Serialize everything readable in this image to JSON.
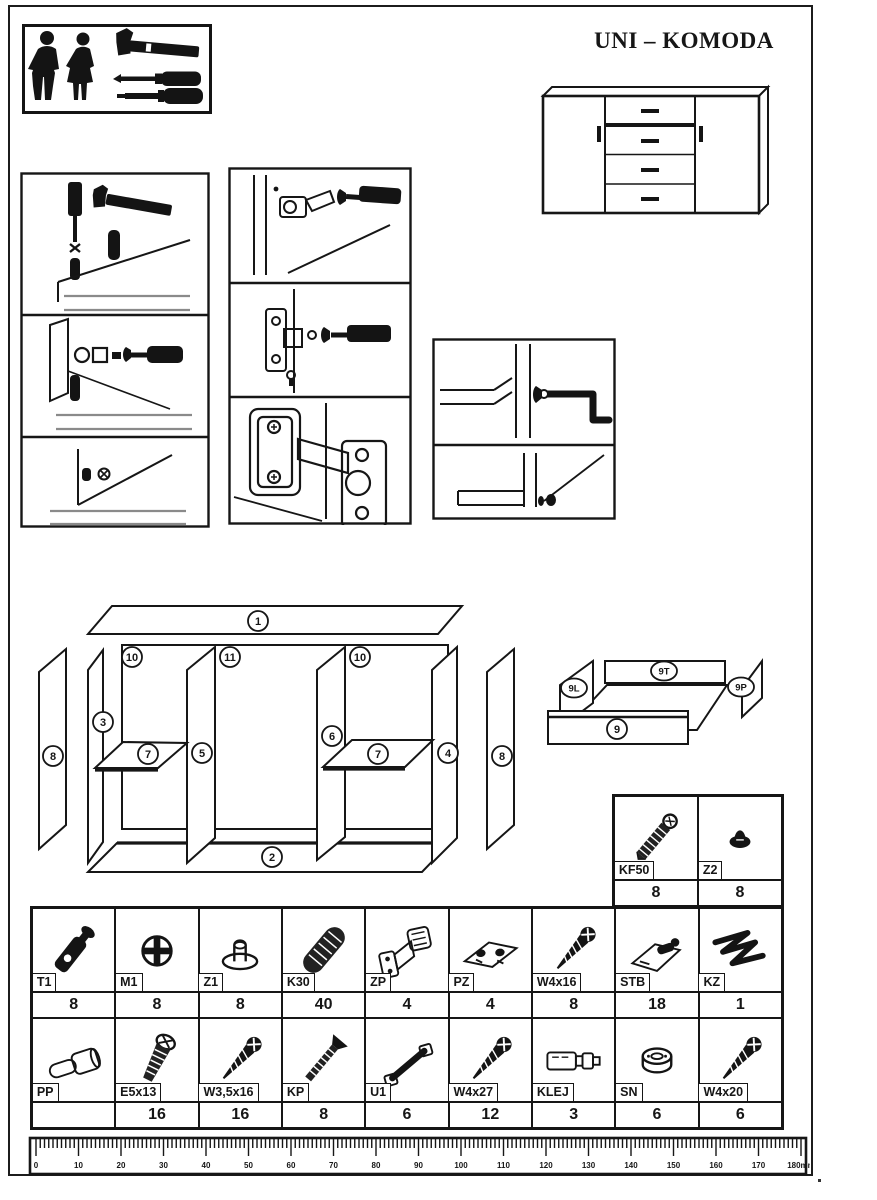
{
  "page": {
    "title": "UNI – KOMODA"
  },
  "tools_box": {
    "icons": [
      "man-silhouette-icon",
      "woman-silhouette-icon",
      "hammer-icon",
      "phillips-screwdriver-icon",
      "flat-screwdriver-icon"
    ]
  },
  "exploded_view": {
    "part_numbers": {
      "top_panel": "1",
      "bottom_panel": "2",
      "left_side_panel": "3",
      "right_side_panel": "4",
      "left_divider": "5",
      "right_divider": "6",
      "shelf": "7",
      "door": "8",
      "drawer_front": "9",
      "drawer_side_left": "9L",
      "drawer_back": "9T",
      "drawer_side_right": "9P",
      "back_panel_left": "10",
      "back_panel_middle": "11",
      "back_panel_right": "10"
    }
  },
  "hardware": {
    "upper_cells": [
      {
        "code": "KF50",
        "qty": "8",
        "icon": "confirmat-screw-icon"
      },
      {
        "code": "Z2",
        "qty": "8",
        "icon": "cover-cap-icon"
      }
    ],
    "row1": [
      {
        "code": "T1",
        "qty": "8",
        "icon": "cam-bolt-icon"
      },
      {
        "code": "M1",
        "qty": "8",
        "icon": "cam-lock-icon"
      },
      {
        "code": "Z1",
        "qty": "8",
        "icon": "glide-icon"
      },
      {
        "code": "K30",
        "qty": "40",
        "icon": "wooden-dowel-icon"
      },
      {
        "code": "ZP",
        "qty": "4",
        "icon": "hinge-icon"
      },
      {
        "code": "PZ",
        "qty": "4",
        "icon": "hinge-plate-icon"
      },
      {
        "code": "W4x16",
        "qty": "8",
        "icon": "screw-icon"
      },
      {
        "code": "STB",
        "qty": "18",
        "icon": "shelf-support-icon"
      },
      {
        "code": "KZ",
        "qty": "1",
        "icon": "allen-key-icon"
      }
    ],
    "row2": [
      {
        "code": "PP",
        "qty": "",
        "icon": "barrel-pin-icon"
      },
      {
        "code": "E5x13",
        "qty": "16",
        "icon": "euro-screw-icon"
      },
      {
        "code": "W3,5x16",
        "qty": "16",
        "icon": "screw-icon"
      },
      {
        "code": "KP",
        "qty": "8",
        "icon": "flat-bolt-icon"
      },
      {
        "code": "U1",
        "qty": "6",
        "icon": "handle-icon"
      },
      {
        "code": "W4x27",
        "qty": "12",
        "icon": "screw-icon"
      },
      {
        "code": "KLEJ",
        "qty": "3",
        "icon": "glue-tube-icon"
      },
      {
        "code": "SN",
        "qty": "6",
        "icon": "round-nut-icon"
      },
      {
        "code": "W4x20",
        "qty": "6",
        "icon": "screw-icon"
      }
    ]
  },
  "ruler": {
    "major_labels": [
      "0",
      "10",
      "20",
      "30",
      "40",
      "50",
      "60",
      "70",
      "80",
      "90",
      "100",
      "110",
      "120",
      "130",
      "140",
      "150",
      "160",
      "170",
      "180mm"
    ],
    "mm_per_major": 10
  }
}
